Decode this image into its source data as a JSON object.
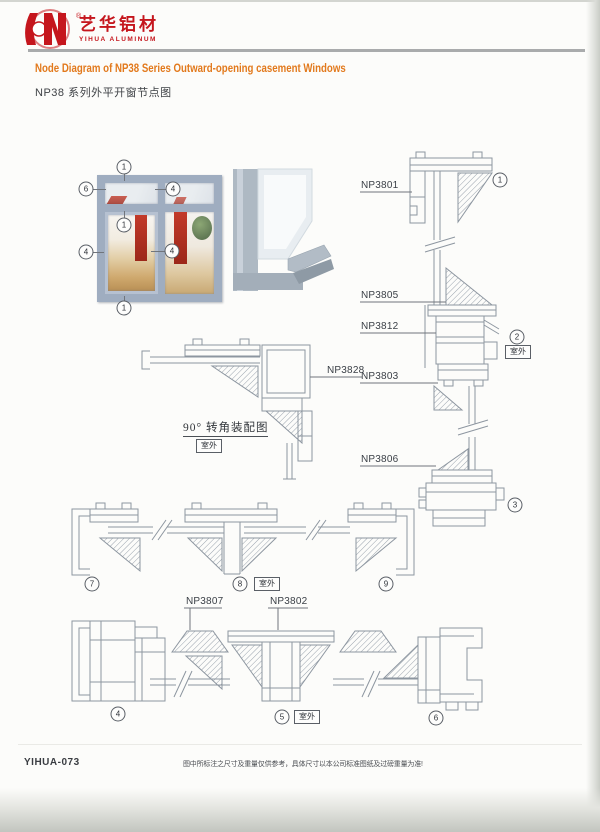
{
  "brand": {
    "name_cn": "艺华铝材",
    "name_en": "YIHUA ALUMINUM",
    "reg": "®"
  },
  "title": {
    "en": "Node Diagram of NP38 Series Outward-opening casement Windows",
    "cn": "NP38 系列外平开窗节点图"
  },
  "photo_callouts": {
    "top": "1",
    "left_top": "6",
    "transom_right": "4",
    "transom_mid": "1",
    "left_mid": "4",
    "center": "4",
    "bottom": "1"
  },
  "section_numbers": {
    "s1": "1",
    "s2": "2",
    "s3": "3",
    "s4": "4",
    "s5": "5",
    "s6": "6",
    "s7": "7",
    "s8": "8",
    "s9": "9"
  },
  "parts": {
    "p3801": "NP3801",
    "p3805": "NP3805",
    "p3812": "NP3812",
    "p3803": "NP3803",
    "p3806": "NP3806",
    "p3828": "NP3828",
    "p3807": "NP3807",
    "p3802": "NP3802"
  },
  "labels": {
    "outdoor": "室外",
    "corner_caption": "90° 转角装配图"
  },
  "footer": {
    "code": "YIHUA-073",
    "disclaimer": "图中所标注之尺寸及重量仅供参考，具体尺寸以本公司标准图纸及过磅重量为准!"
  },
  "colors": {
    "brand_red": "#c5161d",
    "accent_orange": "#e2791c",
    "line_gray": "#8d96a0"
  }
}
